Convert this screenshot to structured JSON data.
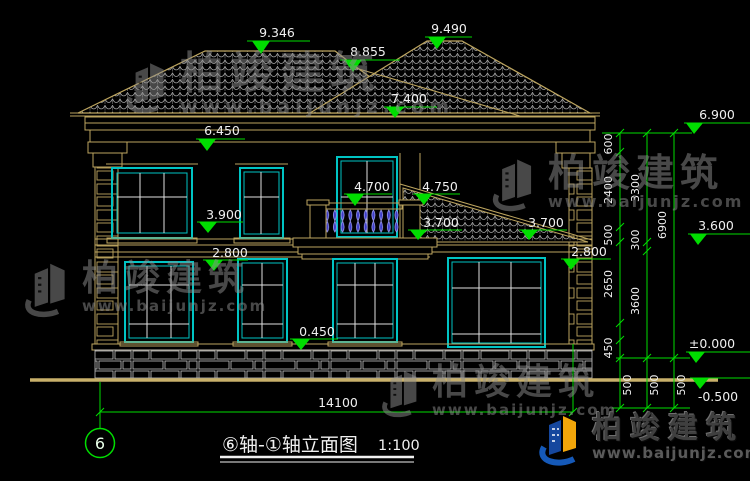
{
  "drawing": {
    "axis_bubble": "6",
    "title": "⑥轴-①轴立面图",
    "scale": "1:100",
    "total_width": "14100"
  },
  "levels": {
    "roof_left_peak": "9.346",
    "roof_step": "8.855",
    "roof_right_peak": "9.490",
    "roof_hip": "7.400",
    "eave_left": "6.450",
    "window_head_upper": "3.900",
    "upper_sill_left": "2.800",
    "balcony_rail": "4.700",
    "balcony_post": "4.750",
    "porch_roof_left": "3.700",
    "porch_roof_right": "3.700",
    "porch_eave_right": "2.800",
    "ground_sill": "0.450",
    "eave_right": "6.900",
    "floor_two": "3.600",
    "ground_zero": "±0.000",
    "below_grade": "-0.500"
  },
  "chains": {
    "a": [
      "600",
      "2400",
      "500",
      "2650",
      "450",
      "500"
    ],
    "b": [
      "3300",
      "300",
      "3600",
      "500"
    ],
    "c": [
      "6900",
      "500"
    ]
  },
  "watermark": {
    "brand": "柏竣建筑",
    "url": "www.baijunjz.com"
  }
}
